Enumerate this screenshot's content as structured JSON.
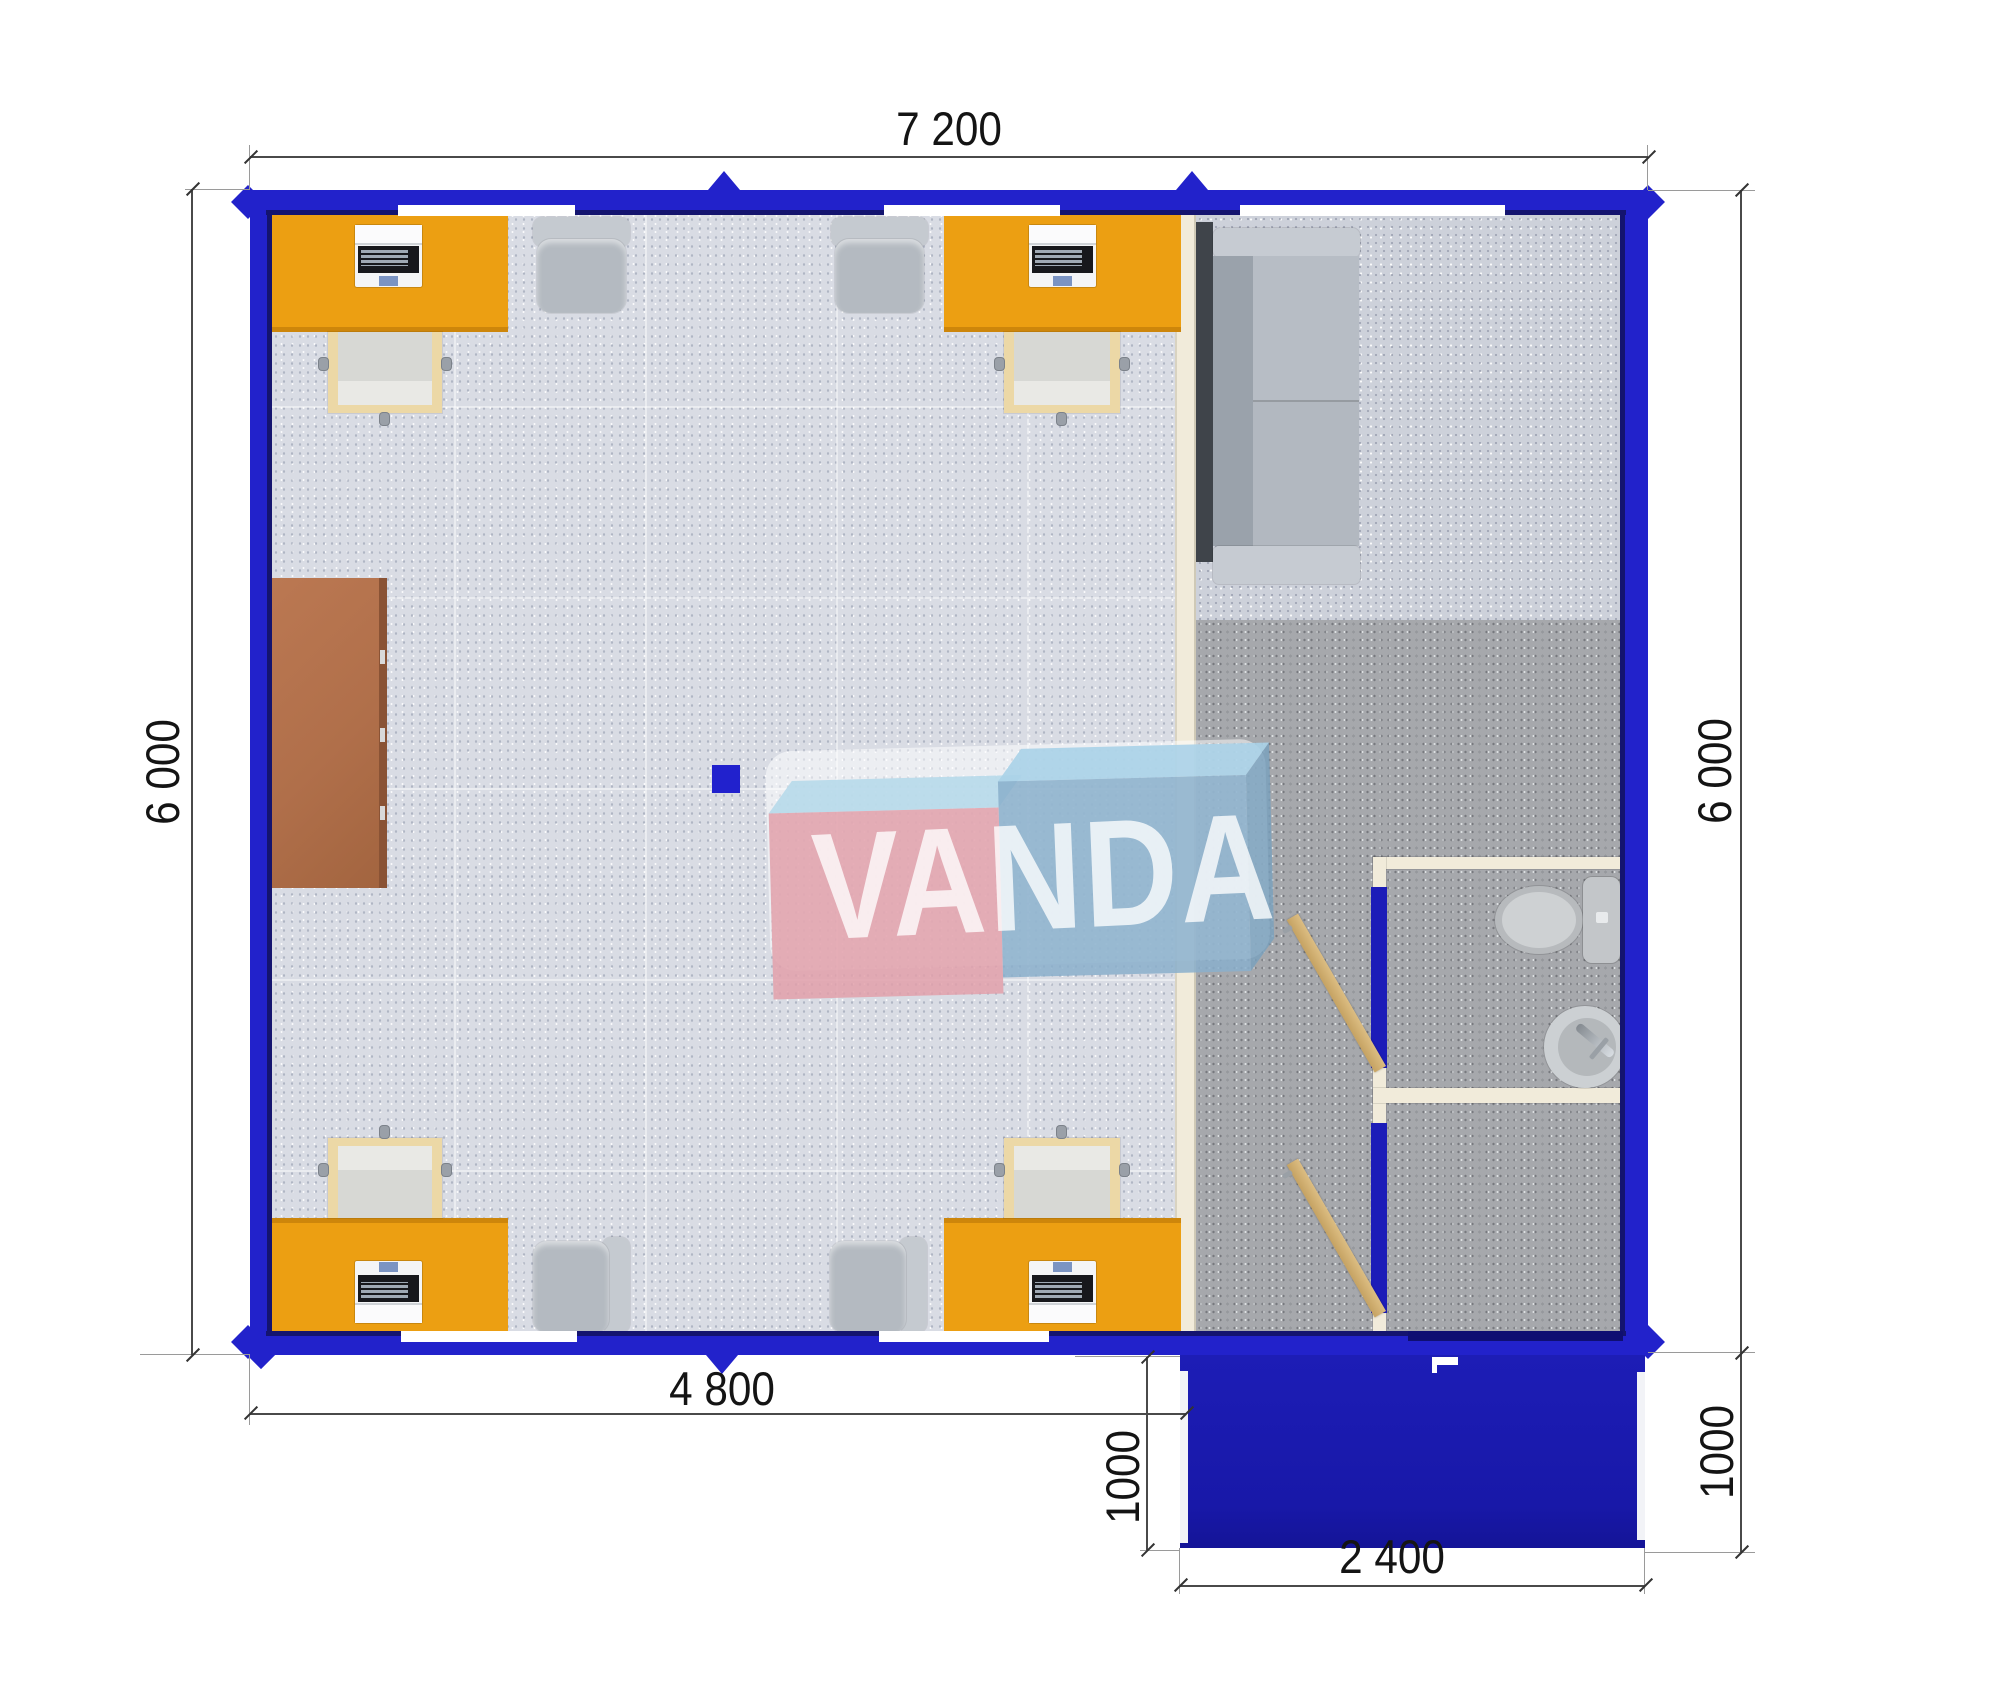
{
  "drawing": {
    "type": "floor-plan-top-view",
    "building": "modular container office with porch",
    "rooms": [
      "office with 4 workstations",
      "lounge with sofa",
      "bathroom with toilet and sink",
      "entrance porch"
    ],
    "furniture": [
      "orange desk with laptop (x4)",
      "side table (x4)",
      "office chair (x4)",
      "brown cabinet",
      "gray sofa",
      "toilet",
      "sink",
      "wooden door (x2)"
    ]
  },
  "dimensions": {
    "top": "7 200",
    "left": "6 000",
    "right": "6 000",
    "bottom_left": "4 800",
    "porch_left": "1000",
    "porch_right": "1000",
    "porch_bottom": "2 400"
  },
  "watermark": {
    "text": "VANDA"
  },
  "colors": {
    "wall_blue": "#2222cb",
    "wall_lining_navy": "#14146f",
    "porch_blue": "#1818a8",
    "desk_orange": "#ec9f12",
    "cabinet_brown": "#b06f4a",
    "partition_cream": "#f1ebda",
    "office_floor": "#d9dce4",
    "right_floor_dark": "#a6a8ac",
    "watermark_pink": "#e2a0aa",
    "watermark_blue": "#89afcb",
    "dimension_text": "#141414"
  }
}
